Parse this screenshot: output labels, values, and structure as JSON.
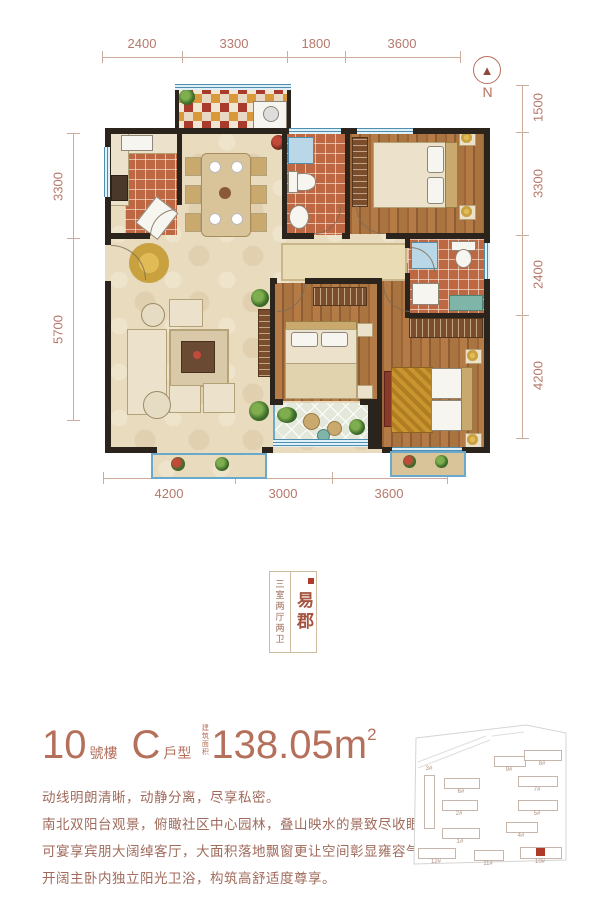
{
  "compass": {
    "label": "N"
  },
  "dimensions": {
    "top": [
      "2400",
      "3300",
      "1800",
      "3600"
    ],
    "left": [
      "3300",
      "5700"
    ],
    "right": [
      "1500",
      "3300",
      "2400",
      "4200"
    ],
    "bottom": [
      "4200",
      "3000",
      "3600"
    ]
  },
  "seal": {
    "layout_label": "三室两厅两卫",
    "project_name": "易郡"
  },
  "title": {
    "building_number": "10",
    "building_suffix": "號樓",
    "unit_letter": "C",
    "unit_suffix": "戶型",
    "area_label": "建筑面积",
    "area_value": "138.05m",
    "area_exponent": "2"
  },
  "description": {
    "line1": "动线明朗清晰，动静分离，尽享私密。",
    "line2": "南北双阳台观景，俯瞰社区中心园林，叠山映水的景致尽收眼底。",
    "line3": "可宴享宾朋大阔绰客厅，大面积落地飘窗更让空间彰显雍容气度。",
    "line4": "开阔主卧内独立阳光卫浴，构筑高舒适度尊享。"
  },
  "siteplan": {
    "buildings": [
      "3#",
      "6#",
      "2#",
      "1#",
      "12#",
      "11#",
      "10#",
      "9#",
      "8#",
      "7#",
      "5#",
      "4#"
    ],
    "highlight_color": "#b03a2a"
  },
  "colors": {
    "accent": "#b5705c",
    "dimension": "#b5786b",
    "wall": "#2b241d",
    "window_blue": "#4e8fae",
    "wood": "#a9713f",
    "tile": "#bd6743",
    "floor_cream": "#e9dbbd",
    "highlight_red": "#b03a2a"
  }
}
